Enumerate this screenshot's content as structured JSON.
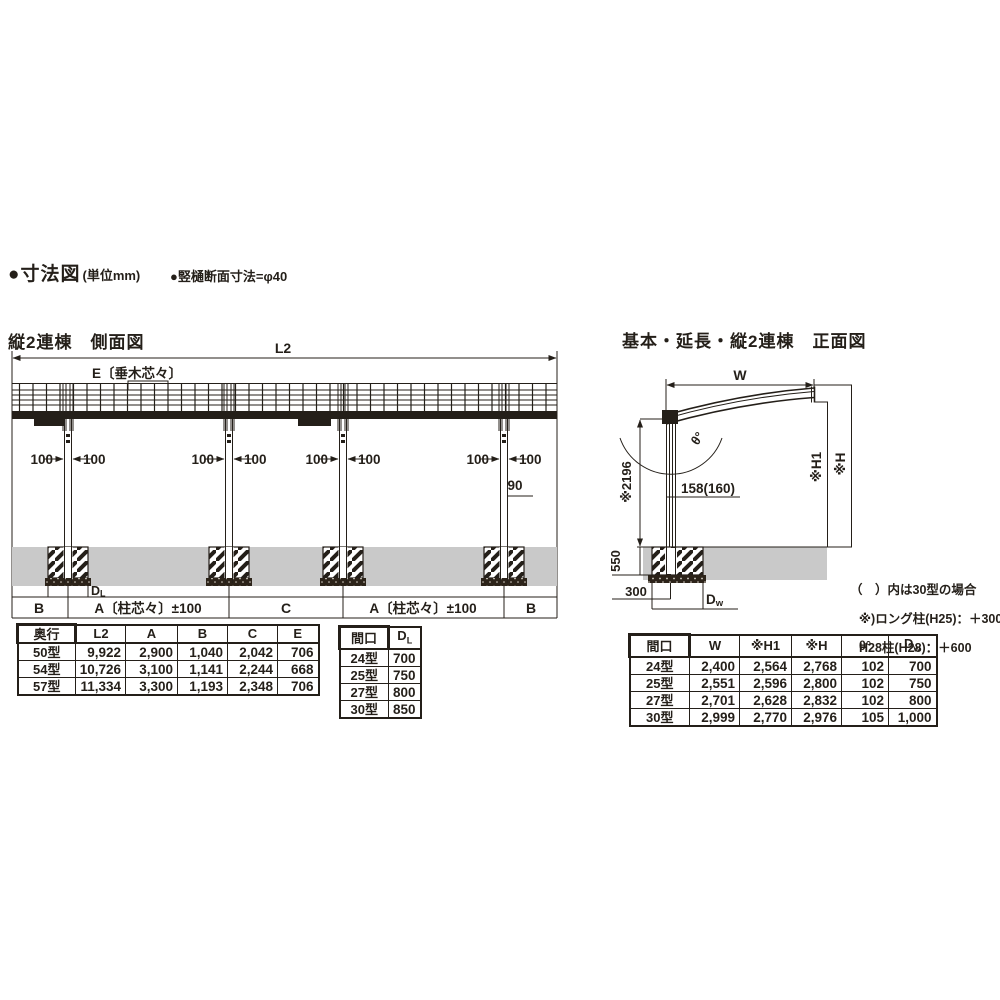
{
  "page": {
    "bg": "#ffffff",
    "ink": "#241f19",
    "ground_gray": "#c9c9c9"
  },
  "header": {
    "dim_title": "●寸法図",
    "dim_unit": "(単位mm)",
    "gutter_note": "●竪樋断面寸法=φ40"
  },
  "side_view": {
    "title": "縦2連棟　側面図",
    "labels": {
      "l2": "L2",
      "e": "E〔垂木芯々〕",
      "dim100": "100",
      "dim90": "90",
      "dl_d": "D",
      "dl_l": "L",
      "b_left": "B",
      "a_left": "A〔柱芯々〕±100",
      "c": "C",
      "a_right": "A〔柱芯々〕±100",
      "b_right": "B"
    }
  },
  "front_view": {
    "title": "基本・延長・縦2連棟　正面図",
    "labels": {
      "w": "W",
      "h1": "※H1",
      "h": "※H",
      "theta": "θ°",
      "v2196": "※2196",
      "col_width": "158(160)",
      "v550": "550",
      "v300": "300",
      "dw_d": "D",
      "dw_w": "w"
    }
  },
  "notes": {
    "line1": "（　）内は30型の場合",
    "line2": "※)ロング柱(H25)：＋300",
    "line3": "H28柱(H28)：＋600"
  },
  "tables": {
    "depth": {
      "headers": [
        "奥行",
        "L2",
        "A",
        "B",
        "C",
        "E"
      ],
      "rows": [
        {
          "label": "50型",
          "cells": [
            "9,922",
            "2,900",
            "1,040",
            "2,042",
            "706"
          ]
        },
        {
          "label": "54型",
          "cells": [
            "10,726",
            "3,100",
            "1,141",
            "2,244",
            "668"
          ]
        },
        {
          "label": "57型",
          "cells": [
            "11,334",
            "3,300",
            "1,193",
            "2,348",
            "706"
          ]
        }
      ]
    },
    "dl": {
      "header_col": "間口",
      "header_d": "D",
      "header_l": "L",
      "rows": [
        {
          "label": "24型",
          "cells": [
            "700"
          ]
        },
        {
          "label": "25型",
          "cells": [
            "750"
          ]
        },
        {
          "label": "27型",
          "cells": [
            "800"
          ]
        },
        {
          "label": "30型",
          "cells": [
            "850"
          ]
        }
      ]
    },
    "front": {
      "headers": [
        "間口",
        "W",
        "※H1",
        "※H",
        "θ°"
      ],
      "header_dw_d": "D",
      "header_dw_w": "w",
      "rows": [
        {
          "label": "24型",
          "cells": [
            "2,400",
            "2,564",
            "2,768",
            "102",
            "700"
          ]
        },
        {
          "label": "25型",
          "cells": [
            "2,551",
            "2,596",
            "2,800",
            "102",
            "750"
          ]
        },
        {
          "label": "27型",
          "cells": [
            "2,701",
            "2,628",
            "2,832",
            "102",
            "800"
          ]
        },
        {
          "label": "30型",
          "cells": [
            "2,999",
            "2,770",
            "2,976",
            "105",
            "1,000"
          ]
        }
      ]
    }
  }
}
